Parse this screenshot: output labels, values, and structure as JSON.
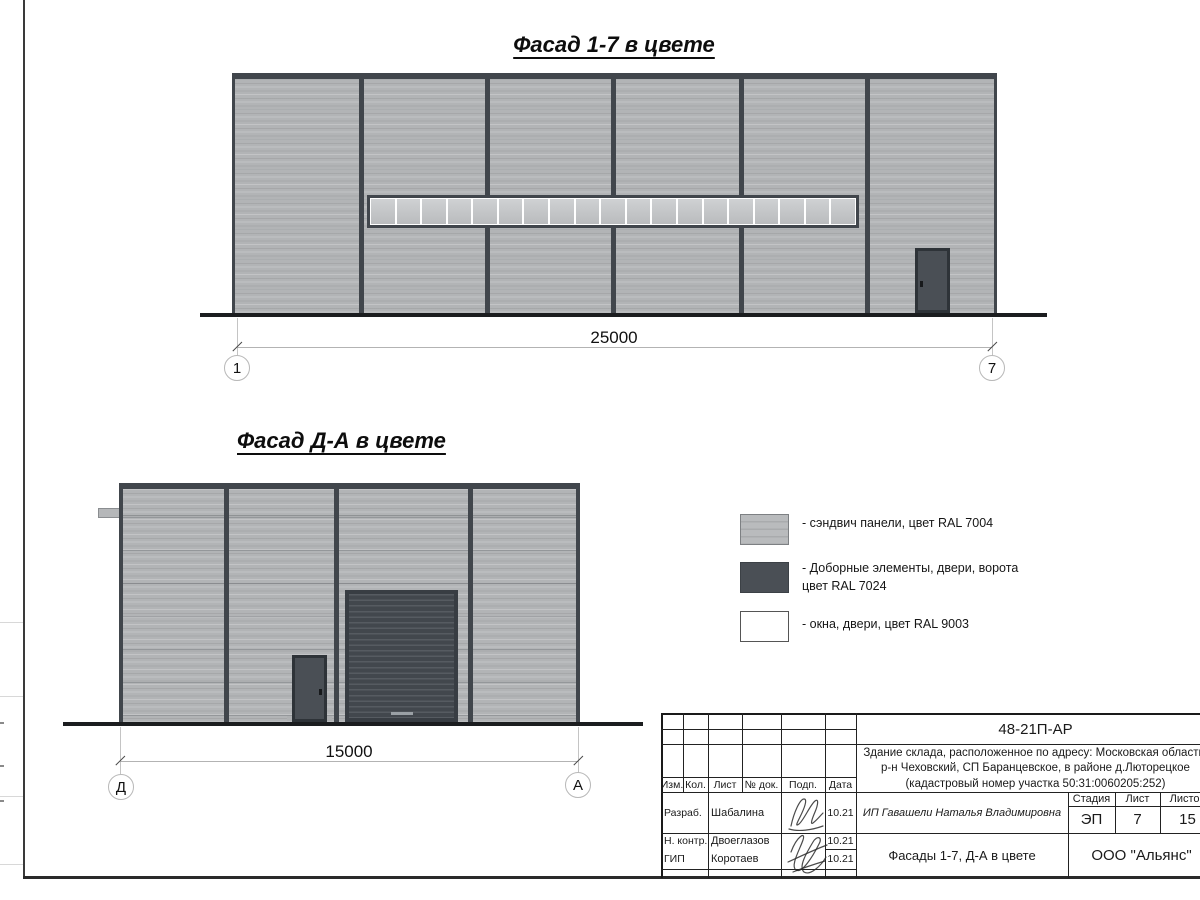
{
  "colors": {
    "panel": "#b2b4b6",
    "panel_joint": "#94979a",
    "frame": "#41464c",
    "dark_el": "#4a4f55",
    "window_white": "#ffffff",
    "ground": "#1b1d1f"
  },
  "facade_top": {
    "title": "Фасад 1-7 в цвете",
    "dimension": "25000",
    "axis_left": "1",
    "axis_right": "7",
    "window_panes": 19
  },
  "facade_side": {
    "title": "Фасад Д-А в цвете",
    "dimension": "15000",
    "axis_left": "Д",
    "axis_right": "А"
  },
  "legend": {
    "items": [
      {
        "label": "- сэндвич панели, цвет RAL 7004"
      },
      {
        "label": "- Доборные элементы, двери, ворота",
        "label2": "цвет RAL 7024"
      },
      {
        "label": "- окна, двери, цвет RAL 9003"
      }
    ]
  },
  "title_block": {
    "code": "48-21П-АР",
    "address_line1": "Здание склада, расположенное по адресу: Московская область,",
    "address_line2": "р-н Чеховский, СП Баранцевское, в районе д.Люторецкое",
    "address_line3": "(кадастровый номер участка 50:31:0060205:252)",
    "col_izm": "Изм.",
    "col_kol": "Кол.",
    "col_list": "Лист",
    "col_doc": "№ док.",
    "col_podp": "Подп.",
    "col_data": "Дата",
    "row1_role": "Разраб.",
    "row1_name": "Шабалина",
    "row1_date": "10.21",
    "row2_role": "Н. контр.",
    "row2_name": "Двоеглазов",
    "row2_date": "10.21",
    "row3_role": "ГИП",
    "row3_name": "Коротаев",
    "row3_date": "10.21",
    "client": "ИП Гавашели Наталья Владимировна",
    "stage_label": "Стадия",
    "sheet_label": "Лист",
    "sheets_label": "Листов",
    "stage": "ЭП",
    "sheet": "7",
    "sheets": "15",
    "drawing_title": "Фасады 1-7, Д-А в цвете",
    "org": "ООО \"Альянс\""
  }
}
